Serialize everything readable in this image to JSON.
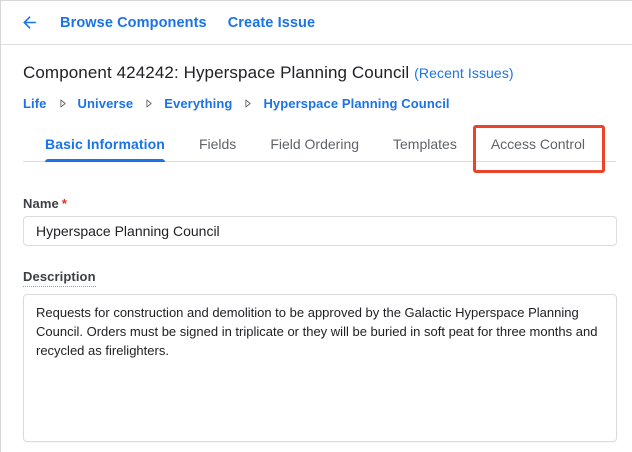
{
  "topbar": {
    "back_icon": "arrow-back",
    "browse_components_label": "Browse Components",
    "create_issue_label": "Create Issue"
  },
  "header": {
    "title": "Component 424242: Hyperspace Planning Council",
    "recent_issues_label": "(Recent Issues)"
  },
  "breadcrumb": {
    "separator_icon": "chevron-right",
    "items": [
      "Life",
      "Universe",
      "Everything",
      "Hyperspace Planning Council"
    ]
  },
  "tabs": [
    {
      "label": "Basic Information",
      "active": true
    },
    {
      "label": "Fields",
      "active": false
    },
    {
      "label": "Field Ordering",
      "active": false
    },
    {
      "label": "Templates",
      "active": false
    },
    {
      "label": "Access Control",
      "active": false,
      "annotated": true
    }
  ],
  "form": {
    "name": {
      "label": "Name",
      "required_marker": "*",
      "value": "Hyperspace Planning Council"
    },
    "description": {
      "label": "Description",
      "value": "Requests for construction and demolition to be approved by the Galactic Hyperspace Planning Council. Orders must be signed in triplicate or they will be buried in soft peat for three months and recycled as firelighters."
    }
  },
  "colors": {
    "link_blue": "#1a73e8",
    "title_text": "#202124",
    "tab_inactive": "#5f6368",
    "label_text": "#3c4043",
    "border_gray": "#dadce0",
    "annotation_red": "#e8452a",
    "required_red": "#d93025",
    "separator_gray": "#5f6368"
  }
}
